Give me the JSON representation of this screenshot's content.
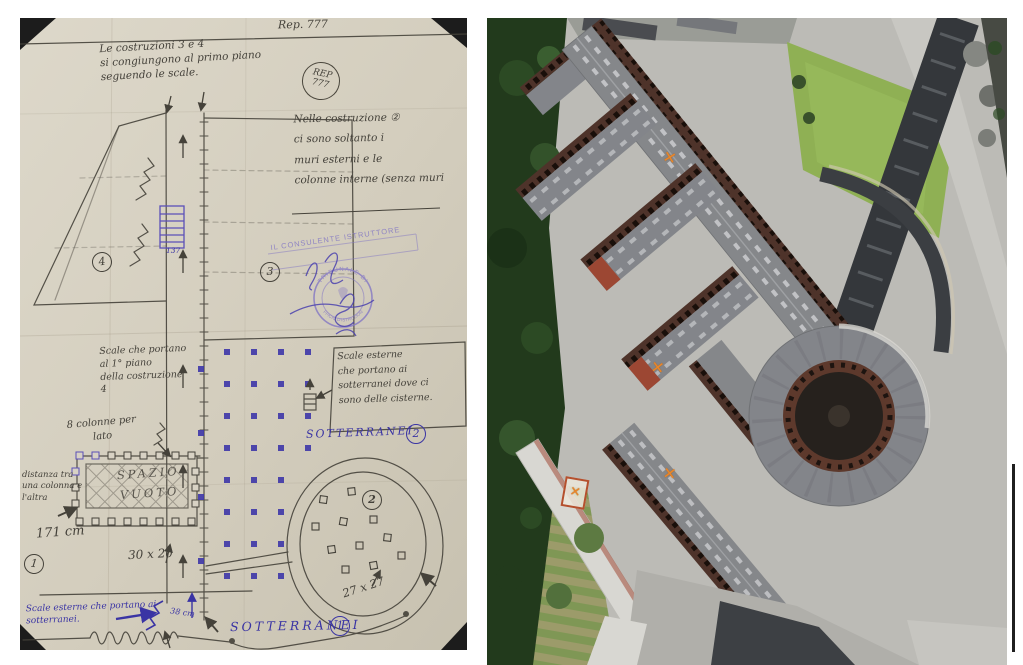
{
  "meta": {
    "left_image_alt": "Hand-drawn floor plan sketch with Italian annotations",
    "right_image_alt": "Aerial photograph of the same building complex",
    "blue_ink": "#3a34a4",
    "stamp_purple": "#8478c4",
    "marker_orange": "#e8862a",
    "paper_color": "#d8d2c4"
  },
  "sketch": {
    "ref_number": "Rep. 777",
    "rep_stamp": {
      "line1": "REP",
      "line2": "777"
    },
    "notes": {
      "top": "Le costruzioni 3 e 4\nsi congiungono al primo piano\nseguendo le scale.",
      "building2": "Nelle costruzione ②\nci sono soltanto i\nmuri esterni e le\ncolonne interne (senza muri",
      "stairs_first_floor": "Scale che portano\nal 1° piano\ndella costruzione\n4",
      "eight_columns": "8 colonne per\nlato",
      "column_distance": "distanza tra\nuna colonna e\nl'altra",
      "column_distance_value": "171 cm",
      "cisterns_box": "Scale esterne\nche portano ai\nsotterranei dove ci\nsono delle cisterne.",
      "basement_stairs_bottom": "Scale esterne che portano ai\nsotterranei.",
      "empty_space": "SPAZIO\nVUOTO"
    },
    "labels": {
      "sotterranei_upper": "SOTTERRANEI",
      "sotterranei_upper_number": "2",
      "sotterranei_lower": "SOTTERRANEI",
      "sotterranei_lower_number": "1"
    },
    "dimensions": {
      "colonnade_column": "30 x 20",
      "oval_column": "27 x 27",
      "stair_step": "38 cm",
      "stair_note": "137"
    },
    "building_numbers": {
      "b1": "1",
      "b2": "2",
      "b3": "3",
      "b4": "4",
      "oval_interior": "2"
    },
    "stamps": {
      "consultant_line": "IL CONSULENTE ISTRUTTORE",
      "tribunal_arc_top": "TRIBUNALE DI",
      "tribunal_arc_bottom": "UFFICIO D'ISTRUZIONE"
    }
  },
  "aerial": {
    "markers": [
      "✕",
      "✕",
      "✕",
      "✕"
    ]
  }
}
